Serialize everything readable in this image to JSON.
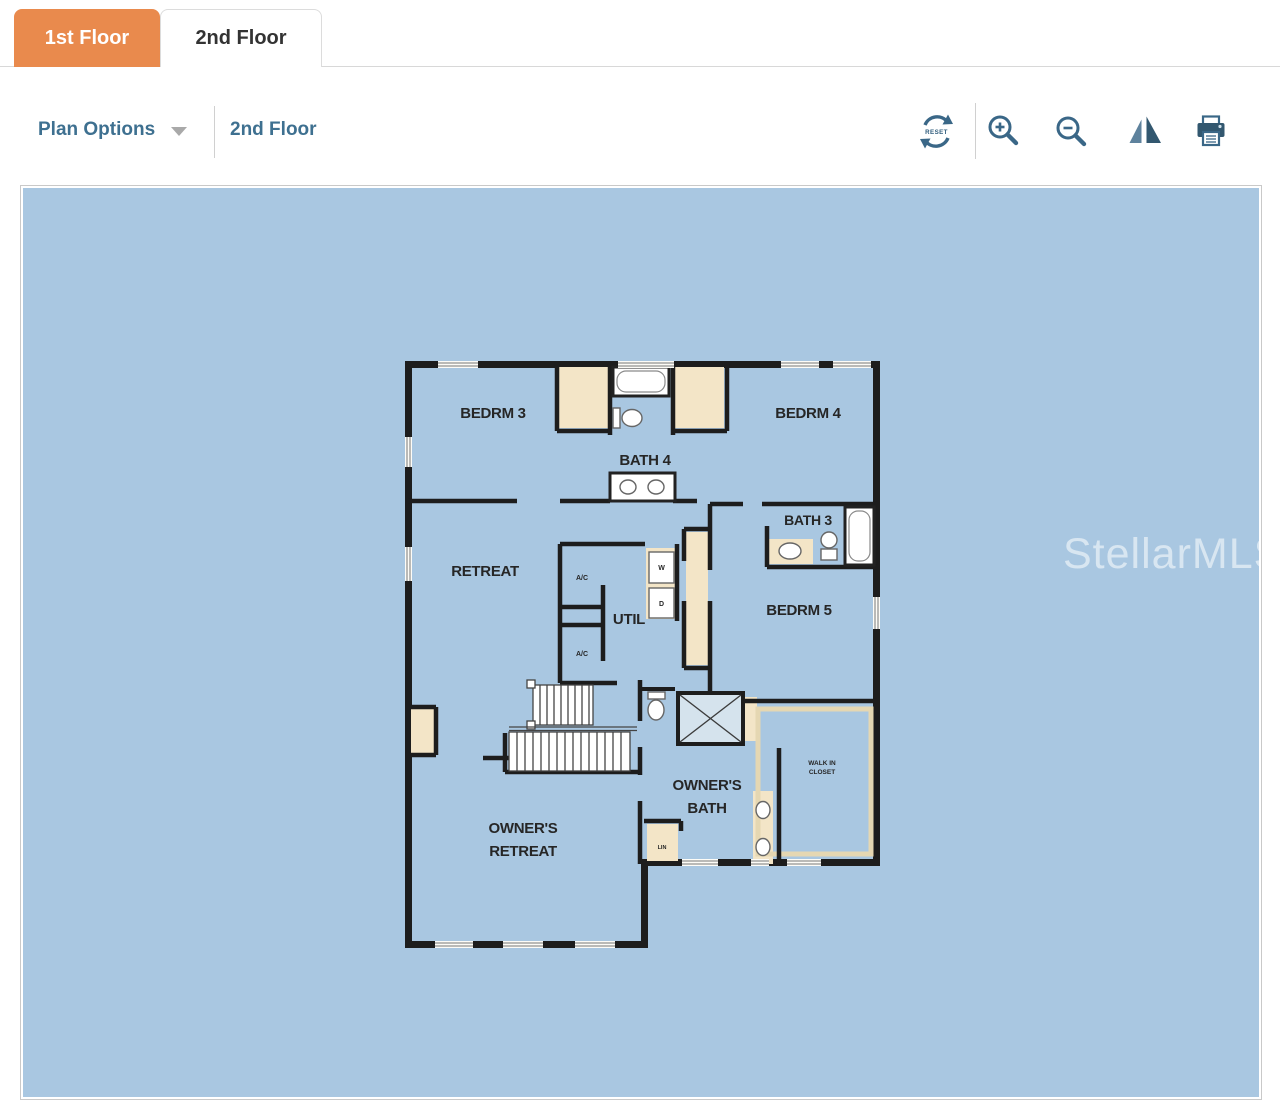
{
  "tabs": [
    {
      "label": "1st Floor",
      "active": true
    },
    {
      "label": "2nd Floor",
      "active": false
    }
  ],
  "toolbar": {
    "plan_options_label": "Plan Options",
    "floor_label": "2nd Floor",
    "reset_label": "RESET",
    "icons": [
      "reset-icon",
      "zoom-in-icon",
      "zoom-out-icon",
      "flip-horizontal-icon",
      "print-icon"
    ]
  },
  "canvas": {
    "watermark": "StellarMLS"
  },
  "floor_plan": {
    "labels": {
      "bedrm3": "BEDRM 3",
      "bedrm4": "BEDRM 4",
      "bath4": "BATH 4",
      "bath3": "BATH 3",
      "retreat": "RETREAT",
      "util": "UTIL",
      "bedrm5": "BEDRM 5",
      "ac": "A/C",
      "washer": "W",
      "dryer": "D",
      "owners_bath_1": "OWNER'S",
      "owners_bath_2": "BATH",
      "owners_retreat_1": "OWNER'S",
      "owners_retreat_2": "RETREAT",
      "walkin_1": "WALK IN",
      "walkin_2": "CLOSET",
      "linen": "LIN"
    }
  },
  "colors": {
    "tab_active_bg": "#e98a4d",
    "toolbar_text": "#3e7090",
    "icon": "#3a6787",
    "canvas_bg": "#a9c7e1",
    "wall": "#1d1d1d",
    "closet_fill": "#f3e5c7",
    "shower_fill": "#d5e3ed"
  }
}
